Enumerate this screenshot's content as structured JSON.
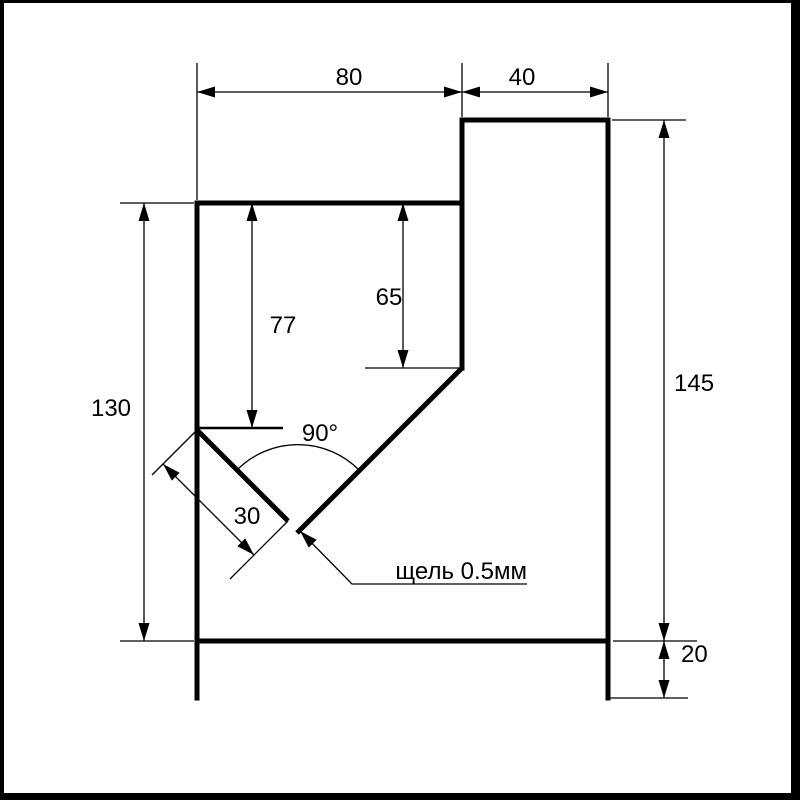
{
  "drawing": {
    "kind": "dimensioned technical drawing of a stepped block with a 45-degree V-slot",
    "labels": {
      "top_width": "80",
      "top_right_width": "40",
      "left_height": "130",
      "inner_left_depth": "77",
      "inner_right_depth": "65",
      "right_height": "145",
      "foot_height": "20",
      "notch_angle": "90°",
      "notch_length": "30",
      "slot_note": "щель 0.5мм"
    },
    "colors": {
      "line": "#000000",
      "background": "#ffffff"
    }
  }
}
